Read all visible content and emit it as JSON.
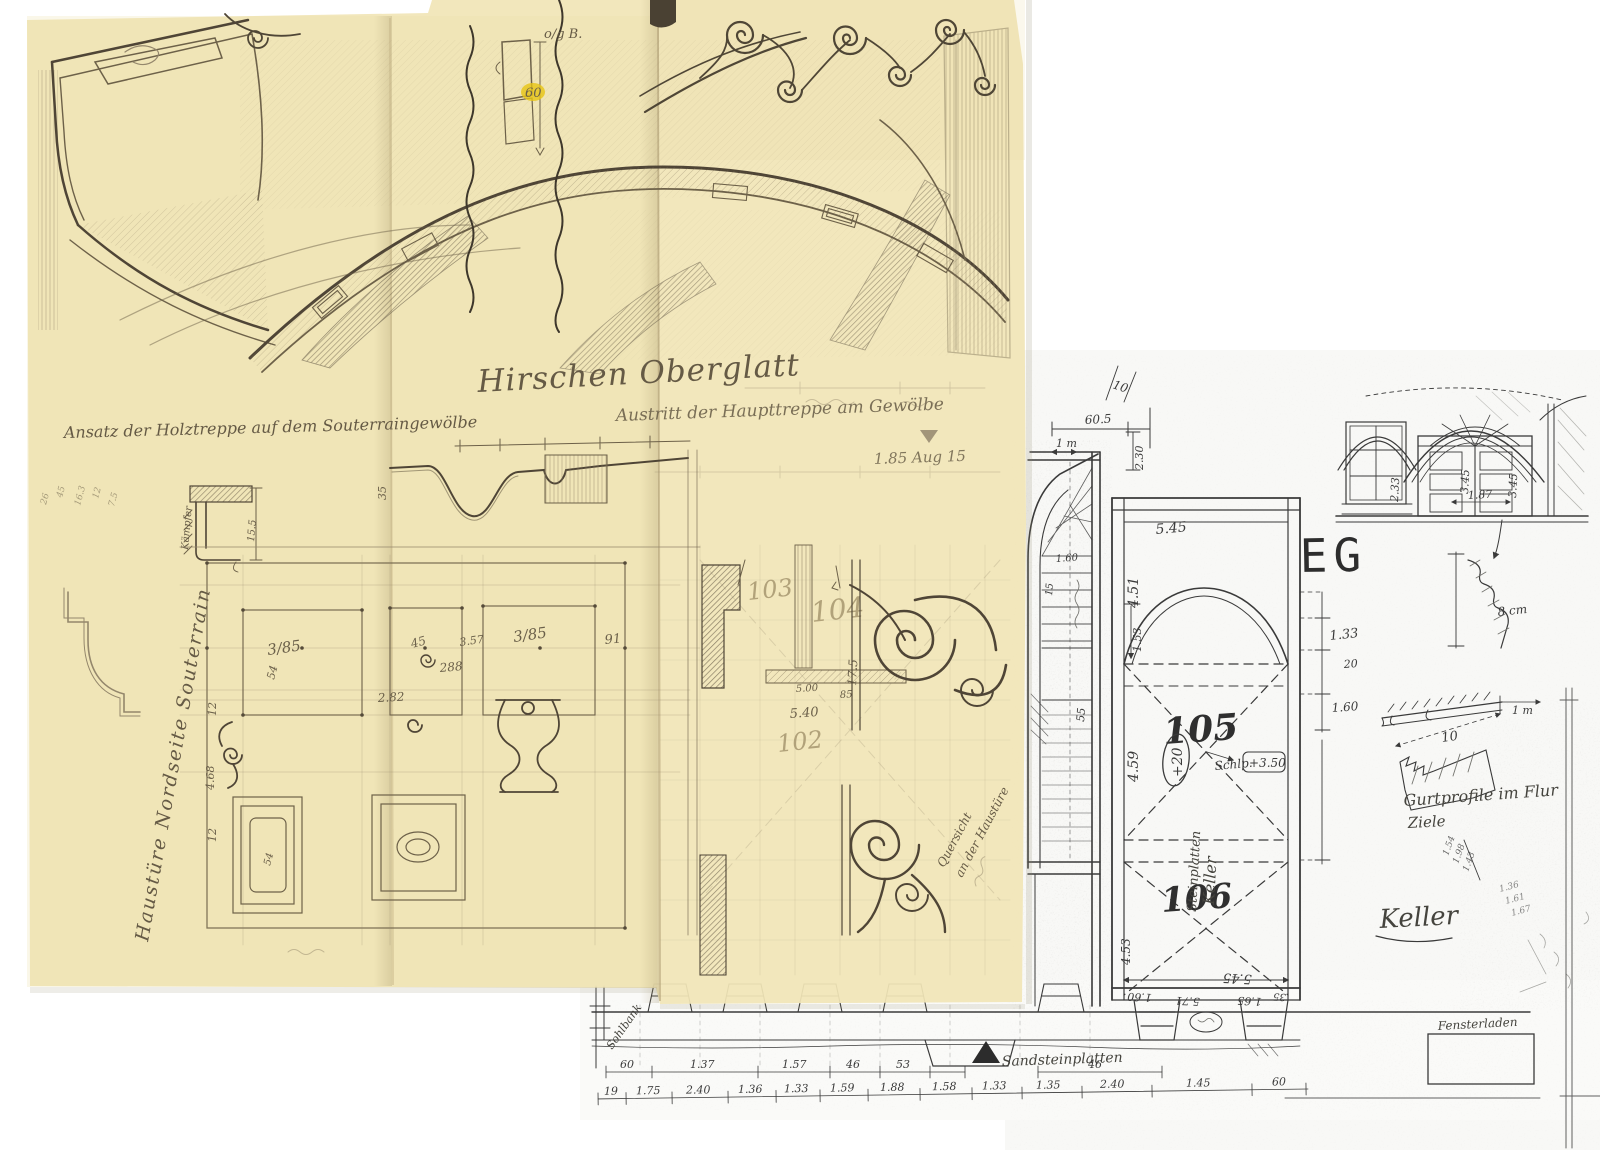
{
  "palette": {
    "paper_yellow": "#f1e5b7",
    "paper_white": "#fdfdfc",
    "pencil": "#6d6149",
    "ink": "#3a3a3a",
    "marker_yellow": "#e7c413"
  },
  "pencil_sheet": {
    "title": "Hirschen Oberglatt",
    "caption_top_right": "Austritt der Haupttreppe am Gewölbe",
    "caption_left": "Ansatz der Holztreppe auf dem Souterraingewölbe",
    "side_caption": "Haustüre Nordseite Souterrain",
    "detail_card_note": "o/g B.",
    "detail_card_value": "60",
    "level_note": "1.85 Aug 15",
    "kaempfer_label": "Kämpfer",
    "kaempfer_dim": "15.5",
    "diag_note_1": "Quersicht",
    "diag_note_2": "an der Haustüre",
    "rooms": {
      "r103": "103",
      "r104": "104",
      "r102": "102"
    },
    "dims": {
      "panel_l": "3/85",
      "panel_l_h": "54",
      "panel_m": "45",
      "panel_m2": "3.57",
      "panel_r": "3/85",
      "edge": "91",
      "ring": "288",
      "width": "2.82",
      "v1": "12",
      "v2": "4.68",
      "v3": "12",
      "sect_a": "5.40",
      "sect_b": "85",
      "sect_c": "5.00",
      "sect_d": "17.5",
      "profile": "35",
      "panel_inner": "54"
    },
    "margin_notes": [
      "26",
      "45",
      "16.3",
      "12",
      "7.5"
    ]
  },
  "ink_plan": {
    "floor_label": "EG",
    "room_105": "105",
    "room_106": "106",
    "level_badge": "+20",
    "level_note_label": "Schlp.",
    "level_note_value": "+3.50",
    "keller_note_1": "Keller",
    "keller_note_2": "Steinplatten",
    "keller_heading": "Keller",
    "gurt_caption_1": "Gurtprofile im Flur",
    "gurt_caption_2": "Ziele",
    "profile_dim": "8 cm",
    "gurt_width": "10",
    "gurt_scale": "1 m",
    "dims": {
      "top_width": "5.45",
      "bottom_width": "5.45",
      "height_upper": "4.51",
      "height_lower": "4.59",
      "height_stair": "4.53",
      "arch_rise": "1.53",
      "right_a": "1.33",
      "right_b": "20",
      "right_c": "1.60",
      "stair_a": "60.5",
      "stair_b": "1 m",
      "stair_c": "2.30",
      "stair_d": "10",
      "step_a": "1.60",
      "step_b": "15",
      "step_c": "55",
      "bay_a": "1.60",
      "bay_b": "5.71",
      "bay_c": "1.65",
      "bay_d": "35"
    },
    "facade_dims": {
      "a": "2.33",
      "b": "3.45",
      "c": "1.87",
      "d": "3.45"
    },
    "cluster_notes": [
      "1.54",
      "1.98",
      "1.43",
      "1.36",
      "1.61",
      "1.67"
    ]
  },
  "bottom_strip": {
    "label_left": "Sohlbank",
    "label_mid": "Sandsteinplatten",
    "label_right": "Fensterladen",
    "dims_upper": [
      "60",
      "1.37",
      "1.57",
      "46",
      "53",
      "46"
    ],
    "dims_lower": [
      "19",
      "1.75",
      "2.40",
      "1.36",
      "1.33",
      "1.59",
      "1.88",
      "1.58",
      "1.33",
      "1.35",
      "2.40",
      "1.45",
      "60"
    ]
  }
}
